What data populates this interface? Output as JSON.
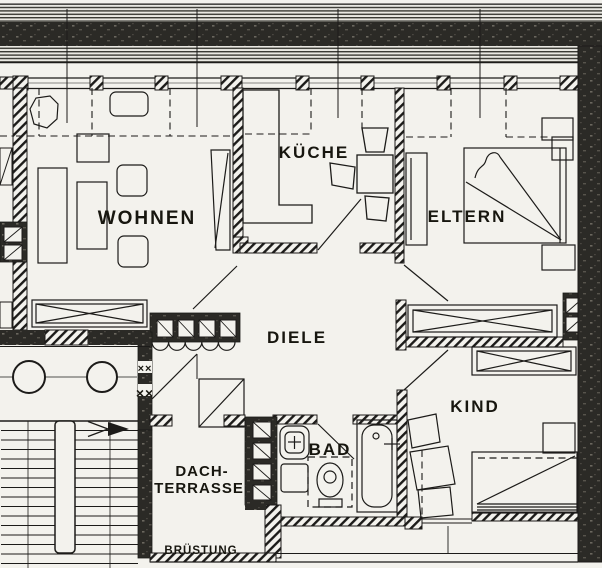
{
  "title": "Dachgeschoss Wohnung Grundriss",
  "colors": {
    "paper": "#f3f2ed",
    "ink": "#1c1b19",
    "wall_dark": "#2b2a26",
    "hatch": "#1c1b19"
  },
  "rooms": {
    "wohnen": {
      "label": "WOHNEN"
    },
    "kueche": {
      "label": "KÜCHE"
    },
    "eltern": {
      "label": "ELTERN"
    },
    "diele": {
      "label": "DIELE"
    },
    "kind": {
      "label": "KIND"
    },
    "bad": {
      "label": "BAD"
    },
    "dachterrasse": {
      "label_line1": "DACH-",
      "label_line2": "TERRASSE"
    }
  },
  "annotations": {
    "bruestung": "BRÜSTUNG",
    "wall_marks_upper": "××",
    "wall_marks_lower": "××"
  }
}
